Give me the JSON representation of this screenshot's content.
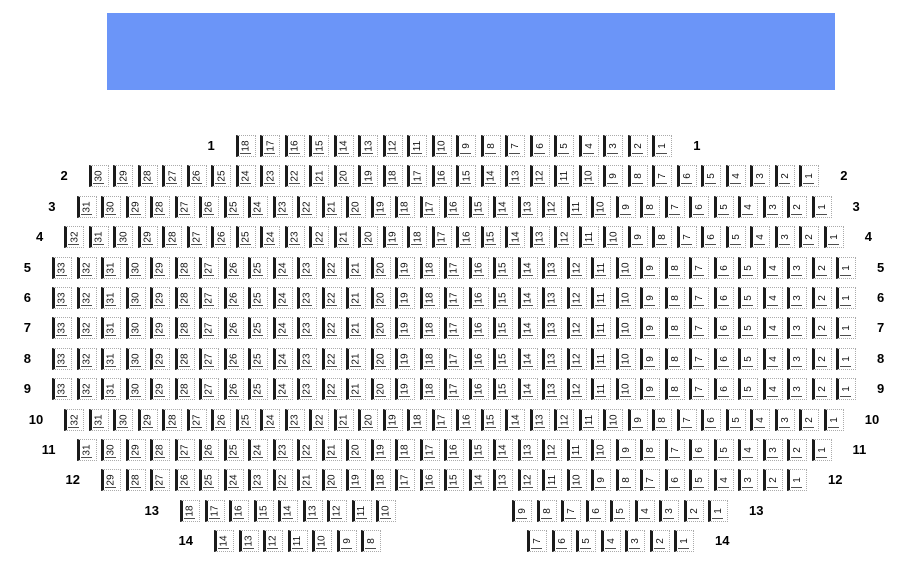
{
  "stage": {
    "color": "#6b95f8",
    "label": ""
  },
  "seating": {
    "rows": [
      {
        "label": "1",
        "groups": [
          [
            18,
            17,
            16,
            15,
            14,
            13,
            12,
            11,
            10,
            9,
            8,
            7,
            6,
            5,
            4,
            3,
            2,
            1
          ]
        ]
      },
      {
        "label": "2",
        "groups": [
          [
            30,
            29,
            28,
            27,
            26,
            25,
            24,
            23,
            22,
            21,
            20,
            19,
            18,
            17,
            16,
            15,
            14,
            13,
            12,
            11,
            10,
            9,
            8,
            7,
            6,
            5,
            4,
            3,
            2,
            1
          ]
        ]
      },
      {
        "label": "3",
        "groups": [
          [
            31,
            30,
            29,
            28,
            27,
            26,
            25,
            24,
            23,
            22,
            21,
            20,
            19,
            18,
            17,
            16,
            15,
            14,
            13,
            12,
            11,
            10,
            9,
            8,
            7,
            6,
            5,
            4,
            3,
            2,
            1
          ]
        ]
      },
      {
        "label": "4",
        "groups": [
          [
            32,
            31,
            30,
            29,
            28,
            27,
            26,
            25,
            24,
            23,
            22,
            21,
            20,
            19,
            18,
            17,
            16,
            15,
            14,
            13,
            12,
            11,
            10,
            9,
            8,
            7,
            6,
            5,
            4,
            3,
            2,
            1
          ]
        ]
      },
      {
        "label": "5",
        "groups": [
          [
            33,
            32,
            31,
            30,
            29,
            28,
            27,
            26,
            25,
            24,
            23,
            22,
            21,
            20,
            19,
            18,
            17,
            16,
            15,
            14,
            13,
            12,
            11,
            10,
            9,
            8,
            7,
            6,
            5,
            4,
            3,
            2,
            1
          ]
        ]
      },
      {
        "label": "6",
        "groups": [
          [
            33,
            32,
            31,
            30,
            29,
            28,
            27,
            26,
            25,
            24,
            23,
            22,
            21,
            20,
            19,
            18,
            17,
            16,
            15,
            14,
            13,
            12,
            11,
            10,
            9,
            8,
            7,
            6,
            5,
            4,
            3,
            2,
            1
          ]
        ]
      },
      {
        "label": "7",
        "groups": [
          [
            33,
            32,
            31,
            30,
            29,
            28,
            27,
            26,
            25,
            24,
            23,
            22,
            21,
            20,
            19,
            18,
            17,
            16,
            15,
            14,
            13,
            12,
            11,
            10,
            9,
            8,
            7,
            6,
            5,
            4,
            3,
            2,
            1
          ]
        ]
      },
      {
        "label": "8",
        "groups": [
          [
            33,
            32,
            31,
            30,
            29,
            28,
            27,
            26,
            25,
            24,
            23,
            22,
            21,
            20,
            19,
            18,
            17,
            16,
            15,
            14,
            13,
            12,
            11,
            10,
            9,
            8,
            7,
            6,
            5,
            4,
            3,
            2,
            1
          ]
        ]
      },
      {
        "label": "9",
        "groups": [
          [
            33,
            32,
            31,
            30,
            29,
            28,
            27,
            26,
            25,
            24,
            23,
            22,
            21,
            20,
            19,
            18,
            17,
            16,
            15,
            14,
            13,
            12,
            11,
            10,
            9,
            8,
            7,
            6,
            5,
            4,
            3,
            2,
            1
          ]
        ]
      },
      {
        "label": "10",
        "groups": [
          [
            32,
            31,
            30,
            29,
            28,
            27,
            26,
            25,
            24,
            23,
            22,
            21,
            20,
            19,
            18,
            17,
            16,
            15,
            14,
            13,
            12,
            11,
            10,
            9,
            8,
            7,
            6,
            5,
            4,
            3,
            2,
            1
          ]
        ]
      },
      {
        "label": "11",
        "groups": [
          [
            31,
            30,
            29,
            28,
            27,
            26,
            25,
            24,
            23,
            22,
            21,
            20,
            19,
            18,
            17,
            16,
            15,
            14,
            13,
            12,
            11,
            10,
            9,
            8,
            7,
            6,
            5,
            4,
            3,
            2,
            1
          ]
        ]
      },
      {
        "label": "12",
        "groups": [
          [
            29,
            28,
            27,
            26,
            25,
            24,
            23,
            22,
            21,
            20,
            19,
            18,
            17,
            16,
            15,
            14,
            13,
            12,
            11,
            10,
            9,
            8,
            7,
            6,
            5,
            4,
            3,
            2,
            1
          ]
        ]
      },
      {
        "label": "13",
        "groups": [
          [
            18,
            17,
            16,
            15,
            14,
            13,
            12,
            11,
            10
          ],
          [
            9,
            8,
            7,
            6,
            5,
            4,
            3,
            2,
            1
          ]
        ]
      },
      {
        "label": "14",
        "groups": [
          [
            14,
            13,
            12,
            11,
            10,
            9,
            8
          ],
          [
            7,
            6,
            5,
            4,
            3,
            2,
            1
          ]
        ]
      }
    ]
  }
}
